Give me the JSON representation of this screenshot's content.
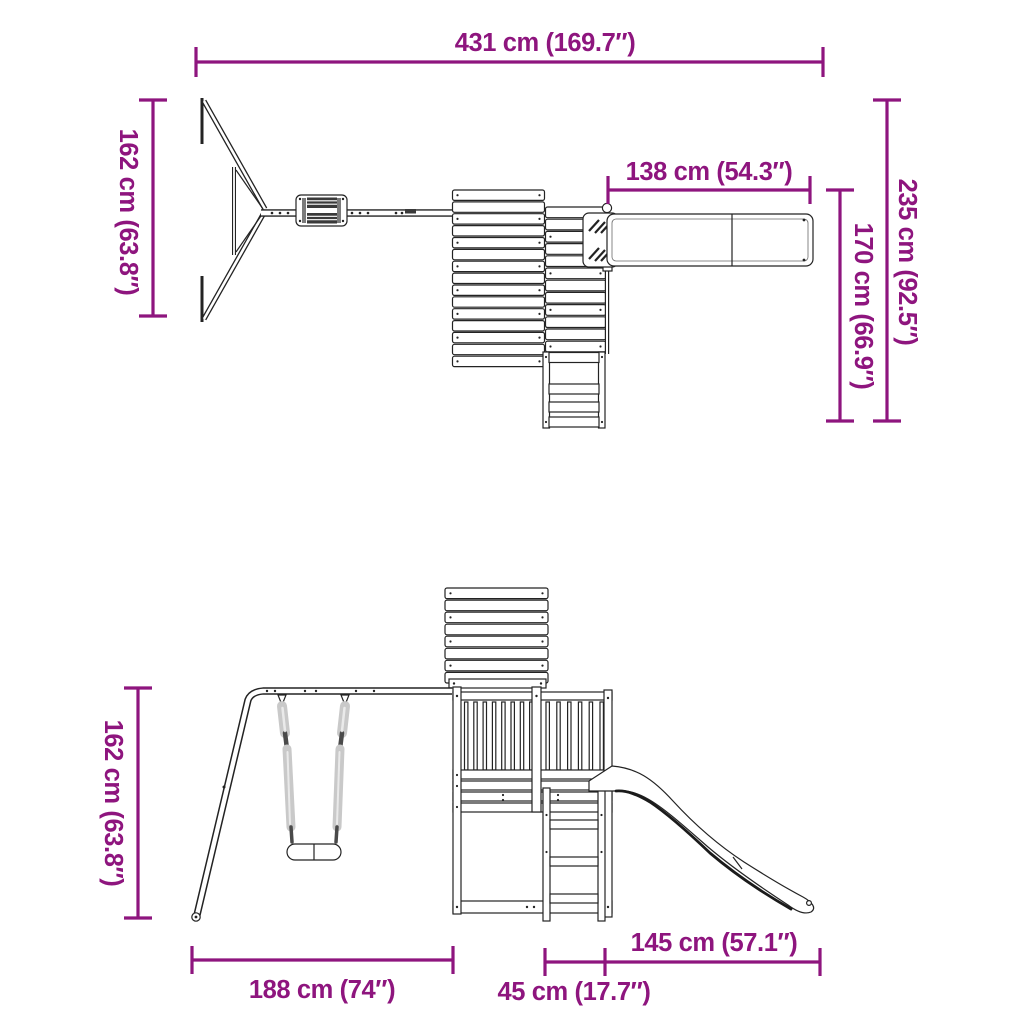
{
  "colors": {
    "dimension_accent": "#8E157E",
    "drawing_line": "#232323",
    "rope_gray": "#c9c9c9",
    "background": "#ffffff"
  },
  "measurements": {
    "overall_width": {
      "cm": 431,
      "inches": 169.7,
      "label": "431 cm (169.7″)"
    },
    "frame_depth": {
      "cm": 162,
      "inches": 63.8,
      "label": "162 cm (63.8″)"
    },
    "slide_top_length": {
      "cm": 138,
      "inches": 54.3,
      "label": "138 cm (54.3″)"
    },
    "overall_depth": {
      "cm": 235,
      "inches": 92.5,
      "label": "235 cm (92.5″)"
    },
    "tower_depth": {
      "cm": 170,
      "inches": 66.9,
      "label": "170 cm (66.9″)"
    },
    "frame_height": {
      "cm": 162,
      "inches": 63.8,
      "label": "162 cm (63.8″)"
    },
    "frame_width": {
      "cm": 188,
      "inches": 74,
      "label": "188 cm (74″)"
    },
    "ladder_width": {
      "cm": 45,
      "inches": 17.7,
      "label": "45 cm (17.7″)"
    },
    "slide_side_length": {
      "cm": 145,
      "inches": 57.1,
      "label": "145 cm (57.1″)"
    }
  }
}
